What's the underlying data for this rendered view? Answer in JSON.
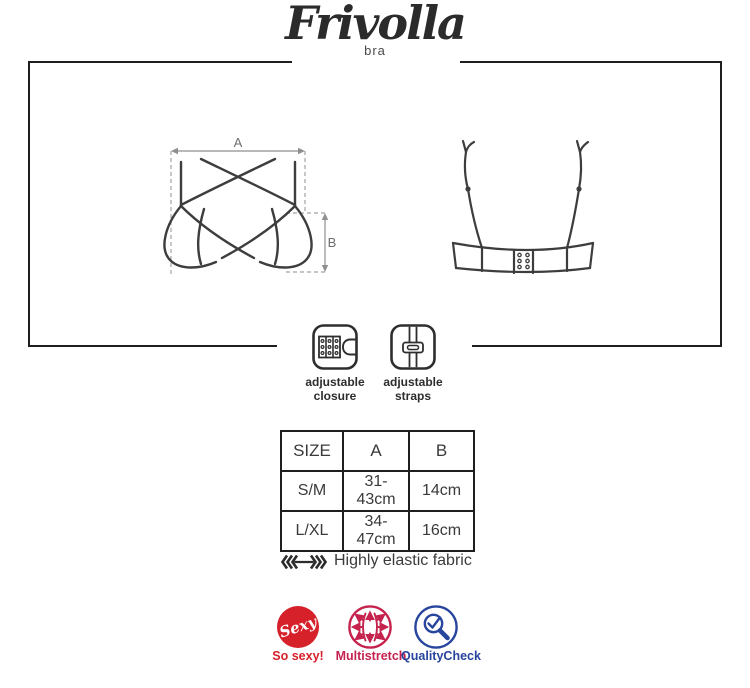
{
  "brand": {
    "name": "Frivolla",
    "tagline": "bra"
  },
  "measurements": {
    "width_label": "A",
    "height_label": "B"
  },
  "features": {
    "closure": {
      "line1": "adjustable",
      "line2": "closure"
    },
    "straps": {
      "line1": "adjustable",
      "line2": "straps"
    }
  },
  "size_table": {
    "headers": [
      "SIZE",
      "A",
      "B"
    ],
    "rows": [
      {
        "size": "S/M",
        "a": "31-43cm",
        "b": "14cm"
      },
      {
        "size": "L/XL",
        "a": "34-47cm",
        "b": "16cm"
      }
    ]
  },
  "fabric_note": "Highly elastic fabric",
  "badges": {
    "sexy": {
      "icon_text": "Sexy",
      "label": "So sexy!",
      "color": "#d6202a"
    },
    "multistretch": {
      "label": "Multistretch",
      "color": "#c5234e"
    },
    "quality_check": {
      "label": "QualityCheck",
      "color": "#27459c"
    }
  },
  "colors": {
    "frame": "#1e1e1e",
    "line_art": "#3d3d3d",
    "guides": "#a3a3a3"
  }
}
